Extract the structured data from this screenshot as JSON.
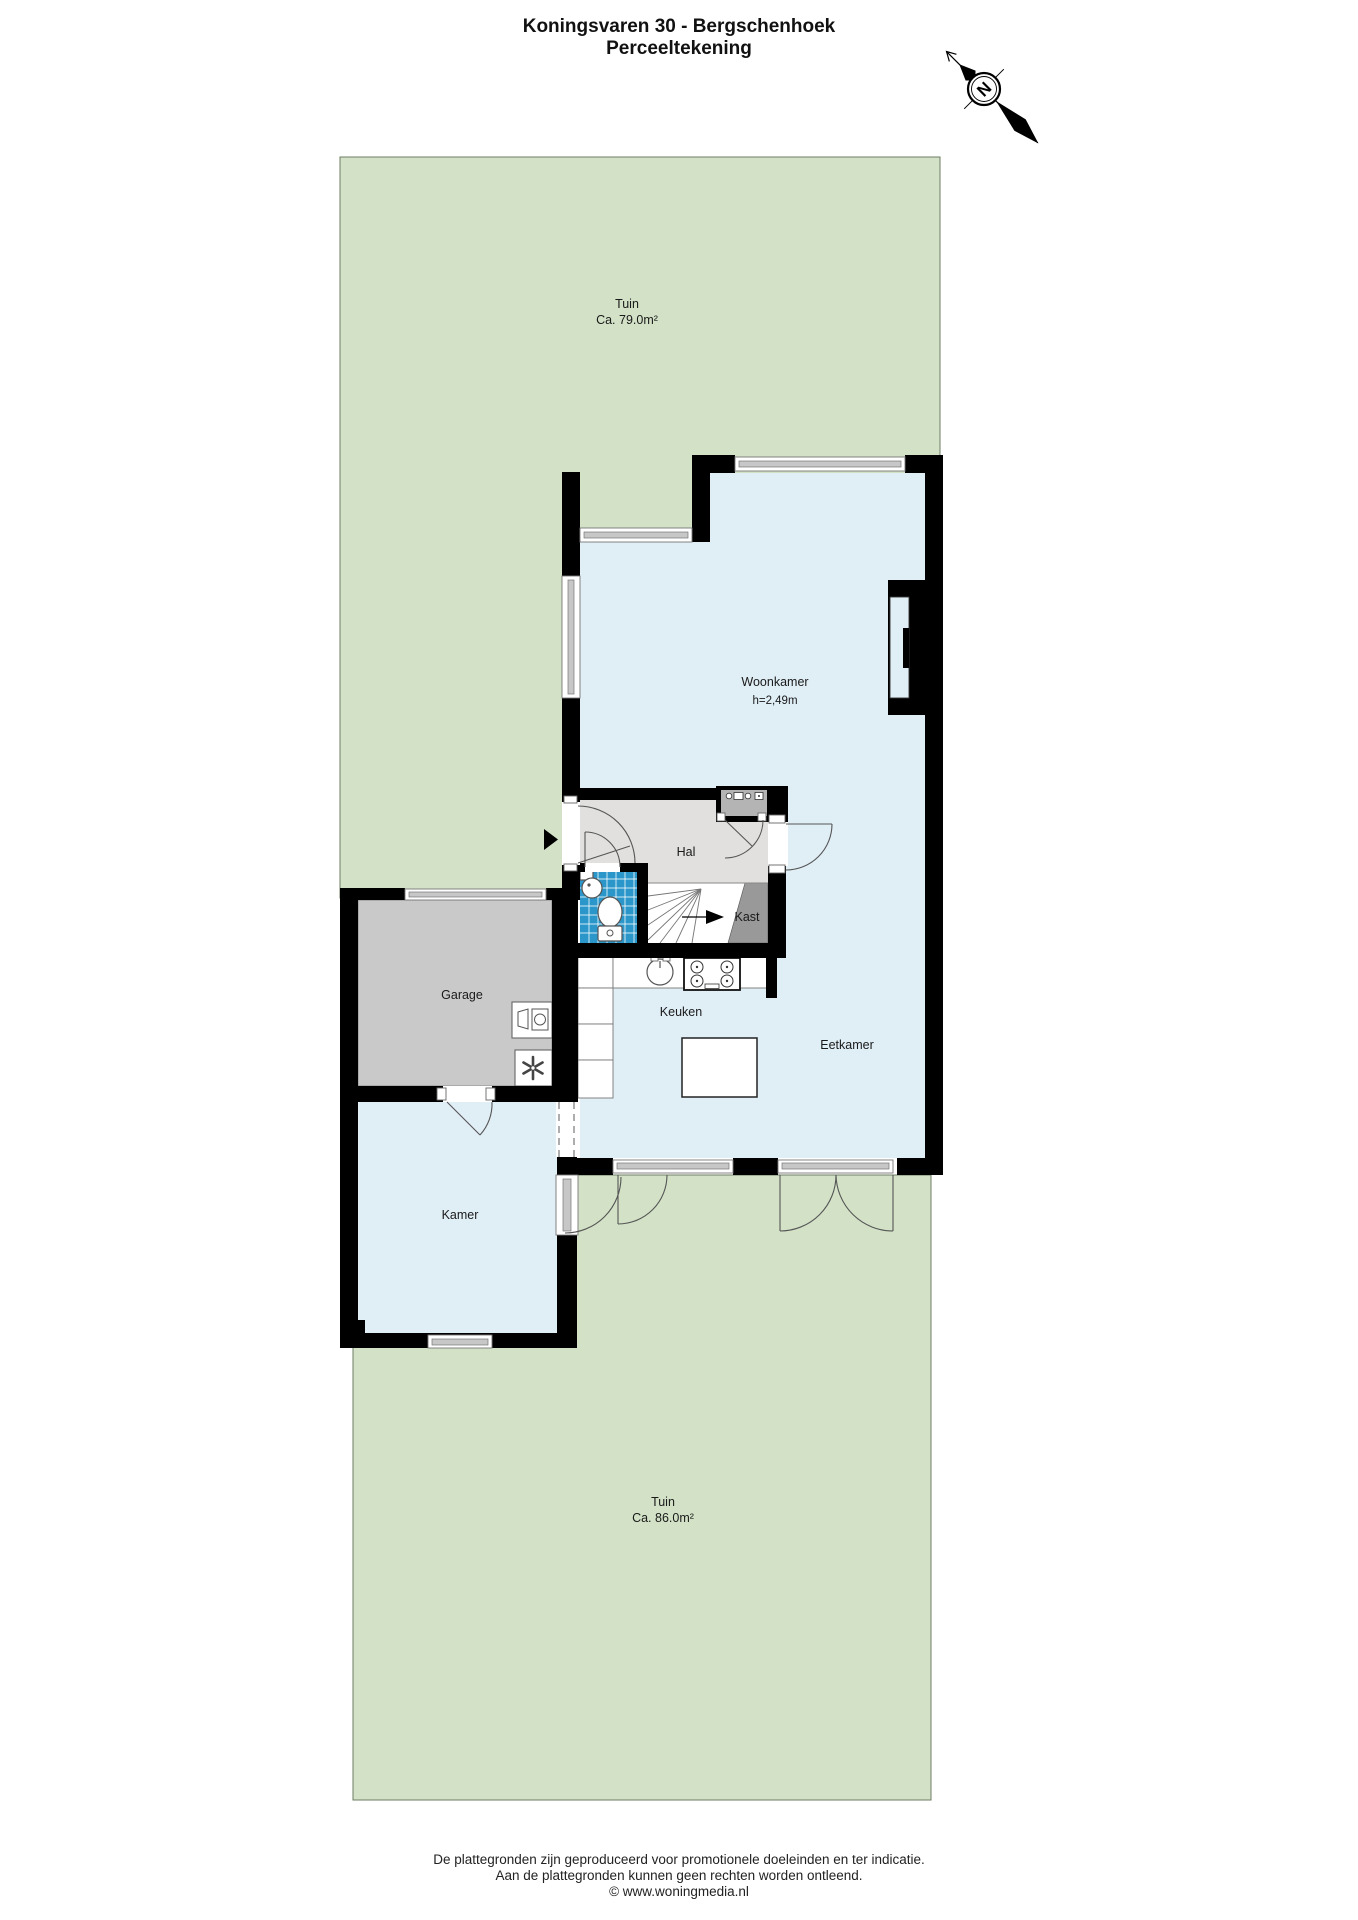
{
  "title": {
    "line1": "Koningsvaren 30 - Bergschenhoek",
    "line2": "Perceeltekening"
  },
  "compass": {
    "north_label": "N"
  },
  "plan": {
    "garden_top": {
      "label": "Tuin",
      "area": "Ca. 79.0m²"
    },
    "garden_bottom": {
      "label": "Tuin",
      "area": "Ca. 86.0m²"
    },
    "rooms": {
      "woonkamer": {
        "label": "Woonkamer",
        "ceiling_height": "h=2,49m"
      },
      "hal": {
        "label": "Hal"
      },
      "kast": {
        "label": "Kast"
      },
      "garage": {
        "label": "Garage"
      },
      "keuken": {
        "label": "Keuken"
      },
      "eetkamer": {
        "label": "Eetkamer"
      },
      "kamer": {
        "label": "Kamer"
      }
    }
  },
  "footer": {
    "line1": "De plattegronden zijn geproduceerd voor promotionele doeleinden en ter indicatie.",
    "line2": "Aan de plattegronden kunnen geen rechten worden ontleend.",
    "line3": "© www.woningmedia.nl"
  },
  "colors": {
    "garden": "#d3e2c7",
    "room": "#e0eef6",
    "hal_floor": "#e1e0de",
    "garage_floor": "#c9c9c9",
    "kast": "#999999",
    "meter_cabinet": "#b4b4b4",
    "toilet_tiles": "#2a96ca",
    "wall": "#000000"
  }
}
